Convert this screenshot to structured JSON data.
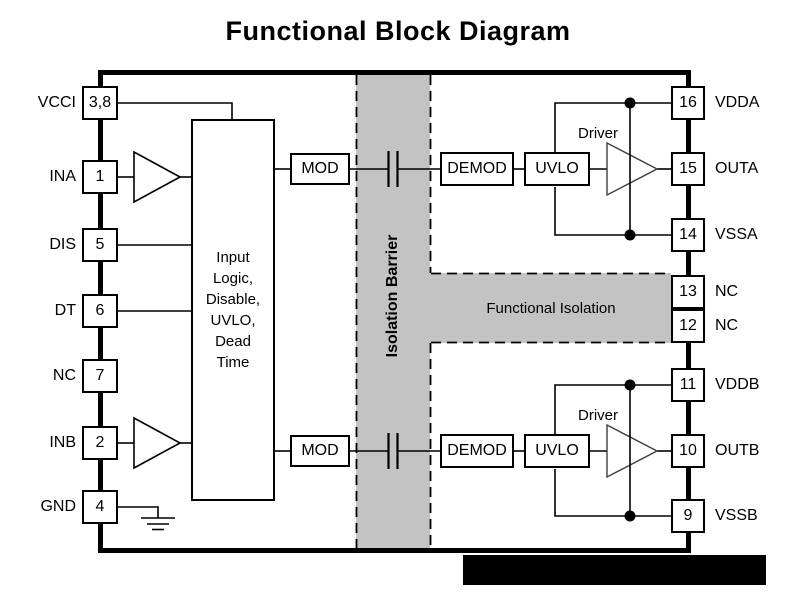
{
  "title": "Functional Block Diagram",
  "chip": {
    "left_pins": [
      {
        "label": "VCCI",
        "pin": "3,8"
      },
      {
        "label": "INA",
        "pin": "1"
      },
      {
        "label": "DIS",
        "pin": "5"
      },
      {
        "label": "DT",
        "pin": "6"
      },
      {
        "label": "NC",
        "pin": "7"
      },
      {
        "label": "INB",
        "pin": "2"
      },
      {
        "label": "GND",
        "pin": "4"
      }
    ],
    "right_pins": [
      {
        "label": "VDDA",
        "pin": "16"
      },
      {
        "label": "OUTA",
        "pin": "15"
      },
      {
        "label": "VSSA",
        "pin": "14"
      },
      {
        "label": "NC",
        "pin": "13"
      },
      {
        "label": "NC",
        "pin": "12"
      },
      {
        "label": "VDDB",
        "pin": "11"
      },
      {
        "label": "OUTB",
        "pin": "10"
      },
      {
        "label": "VSSB",
        "pin": "9"
      }
    ],
    "blocks": {
      "input_logic": "Input\nLogic,\nDisable,\nUVLO,\nDead\nTime",
      "mod": "MOD",
      "demod": "DEMOD",
      "uvlo": "UVLO",
      "driver": "Driver",
      "isolation_barrier": "Isolation Barrier",
      "functional_isolation": "Functional Isolation"
    },
    "colors": {
      "barrier_fill": "#c3c3c3",
      "line": "#000000"
    }
  }
}
